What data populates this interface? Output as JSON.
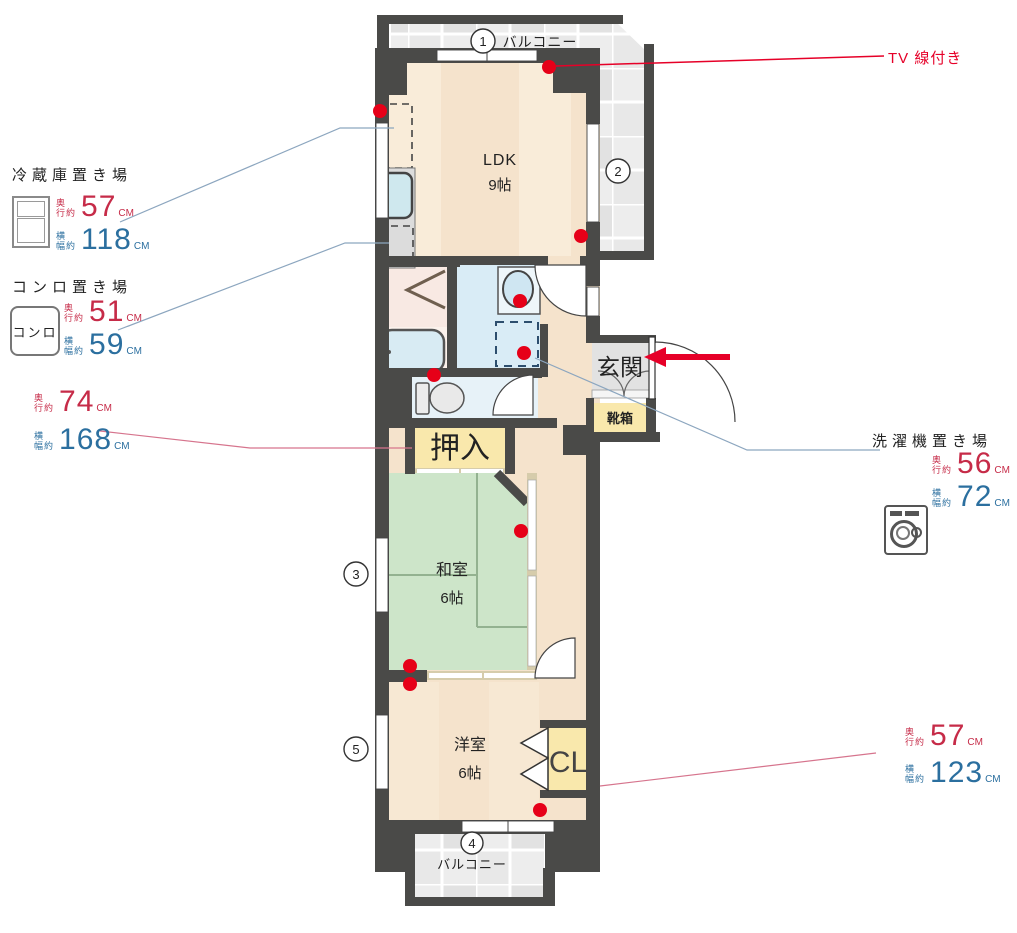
{
  "colors": {
    "wall": "#4a4a48",
    "floor": "#f5e3cc",
    "tatami": "#cde5c9",
    "closet_fill": "#f9e8ac",
    "accent_red": "#e60028",
    "dim_red": "#c62b48",
    "dim_blue": "#2b6f9f"
  },
  "plan": {
    "rooms": {
      "ldk": {
        "name": "LDK",
        "size": "9帖"
      },
      "washitsu": {
        "name": "和室",
        "size": "6帖"
      },
      "youshitsu": {
        "name": "洋室",
        "size": "6帖"
      },
      "oshiire": {
        "name": "押入"
      },
      "genkan": {
        "name": "玄関"
      },
      "shoebox": {
        "name": "靴箱"
      },
      "closet": {
        "name": "CL"
      },
      "balcony_top": {
        "name": "バルコニー"
      },
      "balcony_bottom": {
        "name": "バルコニー"
      }
    },
    "markers": {
      "m1": "1",
      "m2": "2",
      "m3": "3",
      "m4": "4",
      "m5": "5"
    }
  },
  "dim_labels": {
    "depth_top": "奥",
    "depth_bottom": "行約",
    "width_top": "横",
    "width_bottom": "幅約"
  },
  "annotations": {
    "tv": {
      "label": "TV 線付き"
    },
    "fridge": {
      "title": "冷蔵庫置き場",
      "depth_value": "57",
      "depth_unit": "CM",
      "width_value": "118",
      "width_unit": "CM"
    },
    "stove": {
      "title": "コンロ置き場",
      "icon_label": "コンロ",
      "depth_value": "51",
      "depth_unit": "CM",
      "width_value": "59",
      "width_unit": "CM"
    },
    "oshiire": {
      "depth_value": "74",
      "depth_unit": "CM",
      "width_value": "168",
      "width_unit": "CM"
    },
    "washer": {
      "title": "洗濯機置き場",
      "depth_value": "56",
      "depth_unit": "CM",
      "width_value": "72",
      "width_unit": "CM"
    },
    "closet": {
      "depth_value": "57",
      "depth_unit": "CM",
      "width_value": "123",
      "width_unit": "CM"
    }
  }
}
